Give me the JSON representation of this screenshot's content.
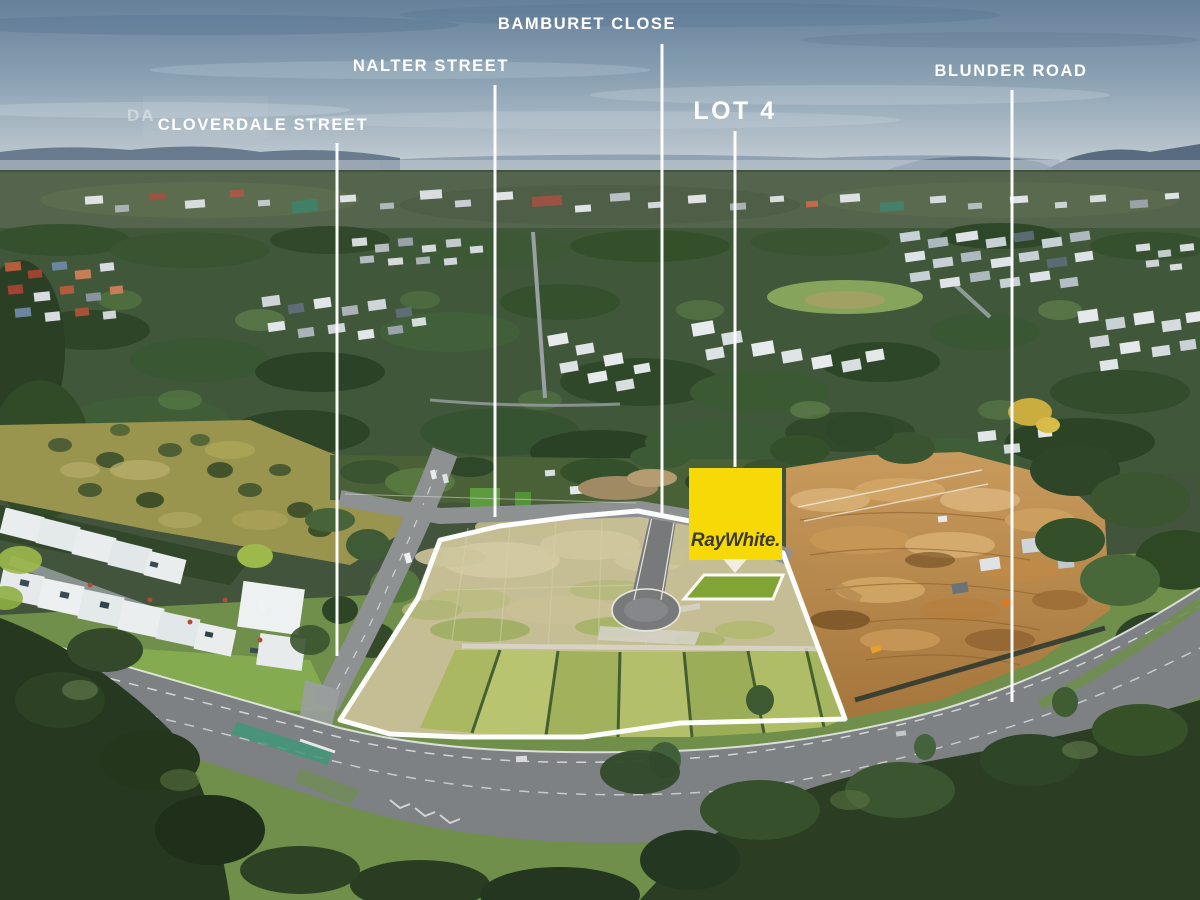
{
  "scene": {
    "description": "Aerial drone photograph of a residential land estate with annotated street names and highlighted Lot 4"
  },
  "annotations": {
    "street_labels": [
      {
        "id": "cloverdale",
        "text": "CLOVERDALE STREET"
      },
      {
        "id": "nalter",
        "text": "NALTER STREET"
      },
      {
        "id": "bamburet",
        "text": "BAMBURET CLOSE"
      },
      {
        "id": "blunder",
        "text": "BLUNDER ROAD"
      }
    ],
    "lot_label": "LOT 4",
    "watermark": "DA"
  },
  "logo": {
    "brand": "RayWhite."
  },
  "colors": {
    "logo_yellow": "#f7d908",
    "logo_text": "#3b3b31",
    "highlight_lot_green": "#7ba32c",
    "annotation_white": "#ffffff"
  }
}
